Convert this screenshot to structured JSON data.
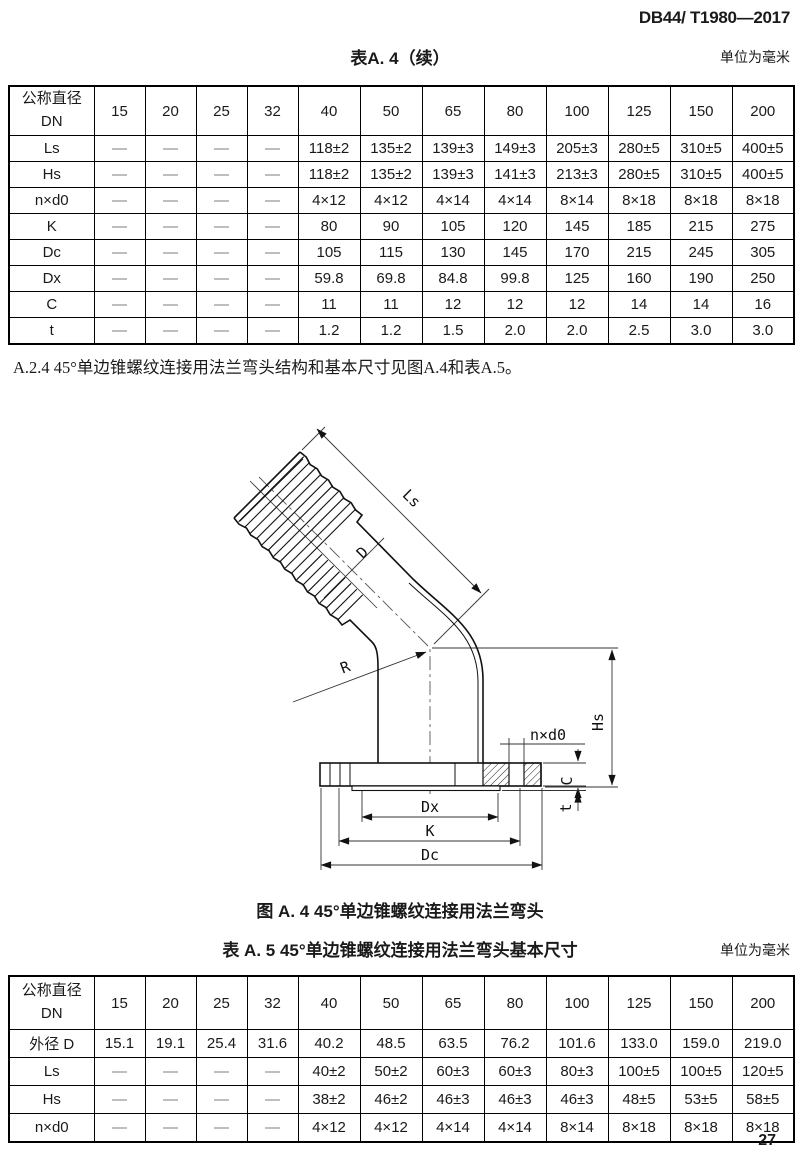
{
  "page": {
    "doc_number": "DB44/ T1980—2017",
    "page_number": "27"
  },
  "table_a4": {
    "title": "表A. 4（续）",
    "unit_note": "单位为毫米",
    "row_header_line1": "公称直径",
    "row_header_line2": "DN",
    "columns": [
      "15",
      "20",
      "25",
      "32",
      "40",
      "50",
      "65",
      "80",
      "100",
      "125",
      "150",
      "200"
    ],
    "rows": [
      {
        "label": "Ls",
        "values": [
          "—",
          "—",
          "—",
          "—",
          "118±2",
          "135±2",
          "139±3",
          "149±3",
          "205±3",
          "280±5",
          "310±5",
          "400±5"
        ]
      },
      {
        "label": "Hs",
        "values": [
          "—",
          "—",
          "—",
          "—",
          "118±2",
          "135±2",
          "139±3",
          "141±3",
          "213±3",
          "280±5",
          "310±5",
          "400±5"
        ]
      },
      {
        "label": "n×d0",
        "values": [
          "—",
          "—",
          "—",
          "—",
          "4×12",
          "4×12",
          "4×14",
          "4×14",
          "8×14",
          "8×18",
          "8×18",
          "8×18"
        ]
      },
      {
        "label": "K",
        "values": [
          "—",
          "—",
          "—",
          "—",
          "80",
          "90",
          "105",
          "120",
          "145",
          "185",
          "215",
          "275"
        ]
      },
      {
        "label": "Dc",
        "values": [
          "—",
          "—",
          "—",
          "—",
          "105",
          "115",
          "130",
          "145",
          "170",
          "215",
          "245",
          "305"
        ]
      },
      {
        "label": "Dx",
        "values": [
          "—",
          "—",
          "—",
          "—",
          "59.8",
          "69.8",
          "84.8",
          "99.8",
          "125",
          "160",
          "190",
          "250"
        ]
      },
      {
        "label": "C",
        "values": [
          "—",
          "—",
          "—",
          "—",
          "11",
          "11",
          "12",
          "12",
          "12",
          "14",
          "14",
          "16"
        ]
      },
      {
        "label": "t",
        "values": [
          "—",
          "—",
          "—",
          "—",
          "1.2",
          "1.2",
          "1.5",
          "2.0",
          "2.0",
          "2.5",
          "3.0",
          "3.0"
        ]
      }
    ]
  },
  "paragraph_a24": {
    "text": "A.2.4  45°单边锥螺纹连接用法兰弯头结构和基本尺寸见图A.4和表A.5。"
  },
  "figure_a4": {
    "caption": "图 A. 4  45°单边锥螺纹连接用法兰弯头",
    "dim_labels": {
      "ls": "Ls",
      "d": "D",
      "r": "R",
      "hs": "Hs",
      "n_d0": "n×d0",
      "c": "C",
      "t": "t",
      "dx": "Dx",
      "k": "K",
      "dc": "Dc"
    }
  },
  "table_a5": {
    "title": "表 A. 5  45°单边锥螺纹连接用法兰弯头基本尺寸",
    "unit_note": "单位为毫米",
    "row_header_line1": "公称直径",
    "row_header_line2": "DN",
    "columns": [
      "15",
      "20",
      "25",
      "32",
      "40",
      "50",
      "65",
      "80",
      "100",
      "125",
      "150",
      "200"
    ],
    "rows": [
      {
        "label": "外径 D",
        "values": [
          "15.1",
          "19.1",
          "25.4",
          "31.6",
          "40.2",
          "48.5",
          "63.5",
          "76.2",
          "101.6",
          "133.0",
          "159.0",
          "219.0"
        ]
      },
      {
        "label": "Ls",
        "values": [
          "—",
          "—",
          "—",
          "—",
          "40±2",
          "50±2",
          "60±3",
          "60±3",
          "80±3",
          "100±5",
          "100±5",
          "120±5"
        ]
      },
      {
        "label": "Hs",
        "values": [
          "—",
          "—",
          "—",
          "—",
          "38±2",
          "46±2",
          "46±3",
          "46±3",
          "46±3",
          "48±5",
          "53±5",
          "58±5"
        ]
      },
      {
        "label": "n×d0",
        "values": [
          "—",
          "—",
          "—",
          "—",
          "4×12",
          "4×12",
          "4×14",
          "4×14",
          "8×14",
          "8×18",
          "8×18",
          "8×18"
        ]
      }
    ]
  }
}
